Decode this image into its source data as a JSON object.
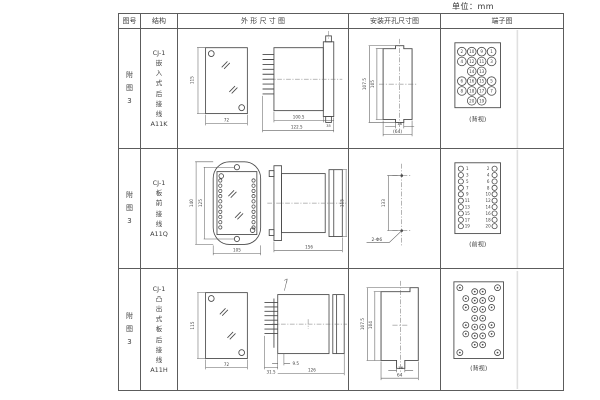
{
  "page": {
    "unit_label": "单位：mm",
    "background": "#ffffff",
    "line_color": "#4a4a4a",
    "text_color": "#3f3f3f"
  },
  "header": {
    "fig_no": "图号",
    "structure": "结构",
    "outline": "外 形 尺 寸 图",
    "mounting": "安装开孔尺寸图",
    "terminal": "端子图"
  },
  "rows": [
    {
      "fig_no": [
        "附",
        "图",
        "3"
      ],
      "structure": [
        "CJ-1",
        "嵌",
        "入",
        "式",
        "后",
        "接",
        "线",
        "A11K"
      ],
      "outline_dims": {
        "front_h": "115",
        "front_w": "72",
        "body_len": "100.5",
        "total_len": "122.5",
        "flange_w": "35"
      },
      "mount_dims": {
        "outer_h": "107.5",
        "inner_h": "105",
        "notch_w": "16",
        "total_w": "(64)"
      },
      "terminal": {
        "caption": "(背视)",
        "circles": [
          {
            "x": 20,
            "y": 22,
            "n": "2"
          },
          {
            "x": 30,
            "y": 22,
            "n": "10"
          },
          {
            "x": 40,
            "y": 22,
            "n": "9"
          },
          {
            "x": 50,
            "y": 22,
            "n": "1"
          },
          {
            "x": 20,
            "y": 32,
            "n": "4"
          },
          {
            "x": 30,
            "y": 32,
            "n": "12"
          },
          {
            "x": 40,
            "y": 32,
            "n": "11"
          },
          {
            "x": 50,
            "y": 32,
            "n": "3"
          },
          {
            "x": 30,
            "y": 42,
            "n": "14"
          },
          {
            "x": 40,
            "y": 42,
            "n": "13"
          },
          {
            "x": 20,
            "y": 52,
            "n": "6"
          },
          {
            "x": 30,
            "y": 52,
            "n": "16"
          },
          {
            "x": 40,
            "y": 52,
            "n": "15"
          },
          {
            "x": 50,
            "y": 52,
            "n": "5"
          },
          {
            "x": 20,
            "y": 62,
            "n": "8"
          },
          {
            "x": 30,
            "y": 62,
            "n": "18"
          },
          {
            "x": 40,
            "y": 62,
            "n": "17"
          },
          {
            "x": 50,
            "y": 62,
            "n": "7"
          },
          {
            "x": 30,
            "y": 72,
            "n": "20"
          },
          {
            "x": 40,
            "y": 72,
            "n": "19"
          }
        ]
      }
    },
    {
      "fig_no": [
        "附",
        "图",
        "3"
      ],
      "structure": [
        "CJ-1",
        "板",
        "前",
        "接",
        "线",
        "A11Q"
      ],
      "outline_dims": {
        "outer_h": "140",
        "inner_h": "125",
        "front_w": "105",
        "side_len": "156",
        "side_h": "115"
      },
      "outline_pins": [
        {
          "x": 43.5,
          "y": 31
        },
        {
          "x": 43.5,
          "y": 36.3
        },
        {
          "x": 43.5,
          "y": 41.6
        },
        {
          "x": 43.5,
          "y": 46.9
        },
        {
          "x": 43.5,
          "y": 52.2
        },
        {
          "x": 43.5,
          "y": 57.5
        },
        {
          "x": 43.5,
          "y": 62.8
        },
        {
          "x": 43.5,
          "y": 68.1
        },
        {
          "x": 43.5,
          "y": 73.4
        },
        {
          "x": 43.5,
          "y": 78.7
        },
        {
          "x": 78.5,
          "y": 31
        },
        {
          "x": 78.5,
          "y": 36.3
        },
        {
          "x": 78.5,
          "y": 41.6
        },
        {
          "x": 78.5,
          "y": 46.9
        },
        {
          "x": 78.5,
          "y": 52.2
        },
        {
          "x": 78.5,
          "y": 57.5
        },
        {
          "x": 78.5,
          "y": 62.8
        },
        {
          "x": 78.5,
          "y": 68.1
        },
        {
          "x": 78.5,
          "y": 73.4
        },
        {
          "x": 78.5,
          "y": 78.7
        }
      ],
      "mount_dims": {
        "hole_span": "133",
        "hole_label": "2-Φ6"
      },
      "terminal": {
        "caption": "(前视)",
        "circles": [
          {
            "x": 19,
            "y": 19
          },
          {
            "x": 19,
            "y": 25.5
          },
          {
            "x": 19,
            "y": 32
          },
          {
            "x": 19,
            "y": 38.5
          },
          {
            "x": 19,
            "y": 45
          },
          {
            "x": 19,
            "y": 51.5
          },
          {
            "x": 19,
            "y": 58
          },
          {
            "x": 19,
            "y": 64.5
          },
          {
            "x": 19,
            "y": 71
          },
          {
            "x": 19,
            "y": 77.5
          },
          {
            "x": 53,
            "y": 19
          },
          {
            "x": 53,
            "y": 25.5
          },
          {
            "x": 53,
            "y": 32
          },
          {
            "x": 53,
            "y": 38.5
          },
          {
            "x": 53,
            "y": 45
          },
          {
            "x": 53,
            "y": 51.5
          },
          {
            "x": 53,
            "y": 58
          },
          {
            "x": 53,
            "y": 64.5
          },
          {
            "x": 53,
            "y": 71
          },
          {
            "x": 53,
            "y": 77.5
          }
        ],
        "labels": [
          {
            "x": 25.5,
            "y": 20.5,
            "t": "1"
          },
          {
            "x": 25.5,
            "y": 27,
            "t": "3"
          },
          {
            "x": 25.5,
            "y": 33.5,
            "t": "5"
          },
          {
            "x": 25.5,
            "y": 40,
            "t": "7"
          },
          {
            "x": 25.5,
            "y": 46.5,
            "t": "9"
          },
          {
            "x": 25.5,
            "y": 53,
            "t": "11"
          },
          {
            "x": 25.5,
            "y": 59.5,
            "t": "13"
          },
          {
            "x": 25.5,
            "y": 66,
            "t": "15"
          },
          {
            "x": 25.5,
            "y": 72.5,
            "t": "17"
          },
          {
            "x": 25.5,
            "y": 79,
            "t": "19"
          },
          {
            "x": 46.5,
            "y": 20.5,
            "t": "2"
          },
          {
            "x": 46.5,
            "y": 27,
            "t": "4"
          },
          {
            "x": 46.5,
            "y": 33.5,
            "t": "6"
          },
          {
            "x": 46.5,
            "y": 40,
            "t": "8"
          },
          {
            "x": 46.5,
            "y": 46.5,
            "t": "10"
          },
          {
            "x": 46.5,
            "y": 53,
            "t": "12"
          },
          {
            "x": 46.5,
            "y": 59.5,
            "t": "14"
          },
          {
            "x": 46.5,
            "y": 66,
            "t": "16"
          },
          {
            "x": 46.5,
            "y": 72.5,
            "t": "18"
          },
          {
            "x": 46.5,
            "y": 79,
            "t": "20"
          }
        ]
      }
    },
    {
      "fig_no": [
        "附",
        "图",
        "3"
      ],
      "structure": [
        "CJ-1",
        "凸",
        "出",
        "式",
        "板",
        "后",
        "接",
        "线",
        "A11H"
      ],
      "outline_dims": {
        "front_h": "115",
        "front_w": "72",
        "pin_len": "31.5",
        "face_gap": "9.5",
        "total_len": "126"
      },
      "mount_dims": {
        "outer_h": "107.5",
        "inner_h": "104",
        "slot_w": "16",
        "total_w": "64"
      },
      "terminal": {
        "caption": "(背视)",
        "circles": [
          {
            "x": 18,
            "y": 17
          },
          {
            "x": 56,
            "y": 17
          },
          {
            "x": 18,
            "y": 83
          },
          {
            "x": 56,
            "y": 83
          },
          {
            "x": 24,
            "y": 28
          },
          {
            "x": 24,
            "y": 37
          },
          {
            "x": 24,
            "y": 55
          },
          {
            "x": 24,
            "y": 64
          },
          {
            "x": 50,
            "y": 28
          },
          {
            "x": 50,
            "y": 37
          },
          {
            "x": 50,
            "y": 55
          },
          {
            "x": 50,
            "y": 64
          },
          {
            "x": 33,
            "y": 21
          },
          {
            "x": 33,
            "y": 30
          },
          {
            "x": 33,
            "y": 39
          },
          {
            "x": 33,
            "y": 48
          },
          {
            "x": 33,
            "y": 57
          },
          {
            "x": 33,
            "y": 66
          },
          {
            "x": 33,
            "y": 75
          },
          {
            "x": 41,
            "y": 21
          },
          {
            "x": 41,
            "y": 30
          },
          {
            "x": 41,
            "y": 39
          },
          {
            "x": 41,
            "y": 48
          },
          {
            "x": 41,
            "y": 57
          },
          {
            "x": 41,
            "y": 66
          },
          {
            "x": 41,
            "y": 75
          }
        ]
      }
    }
  ]
}
